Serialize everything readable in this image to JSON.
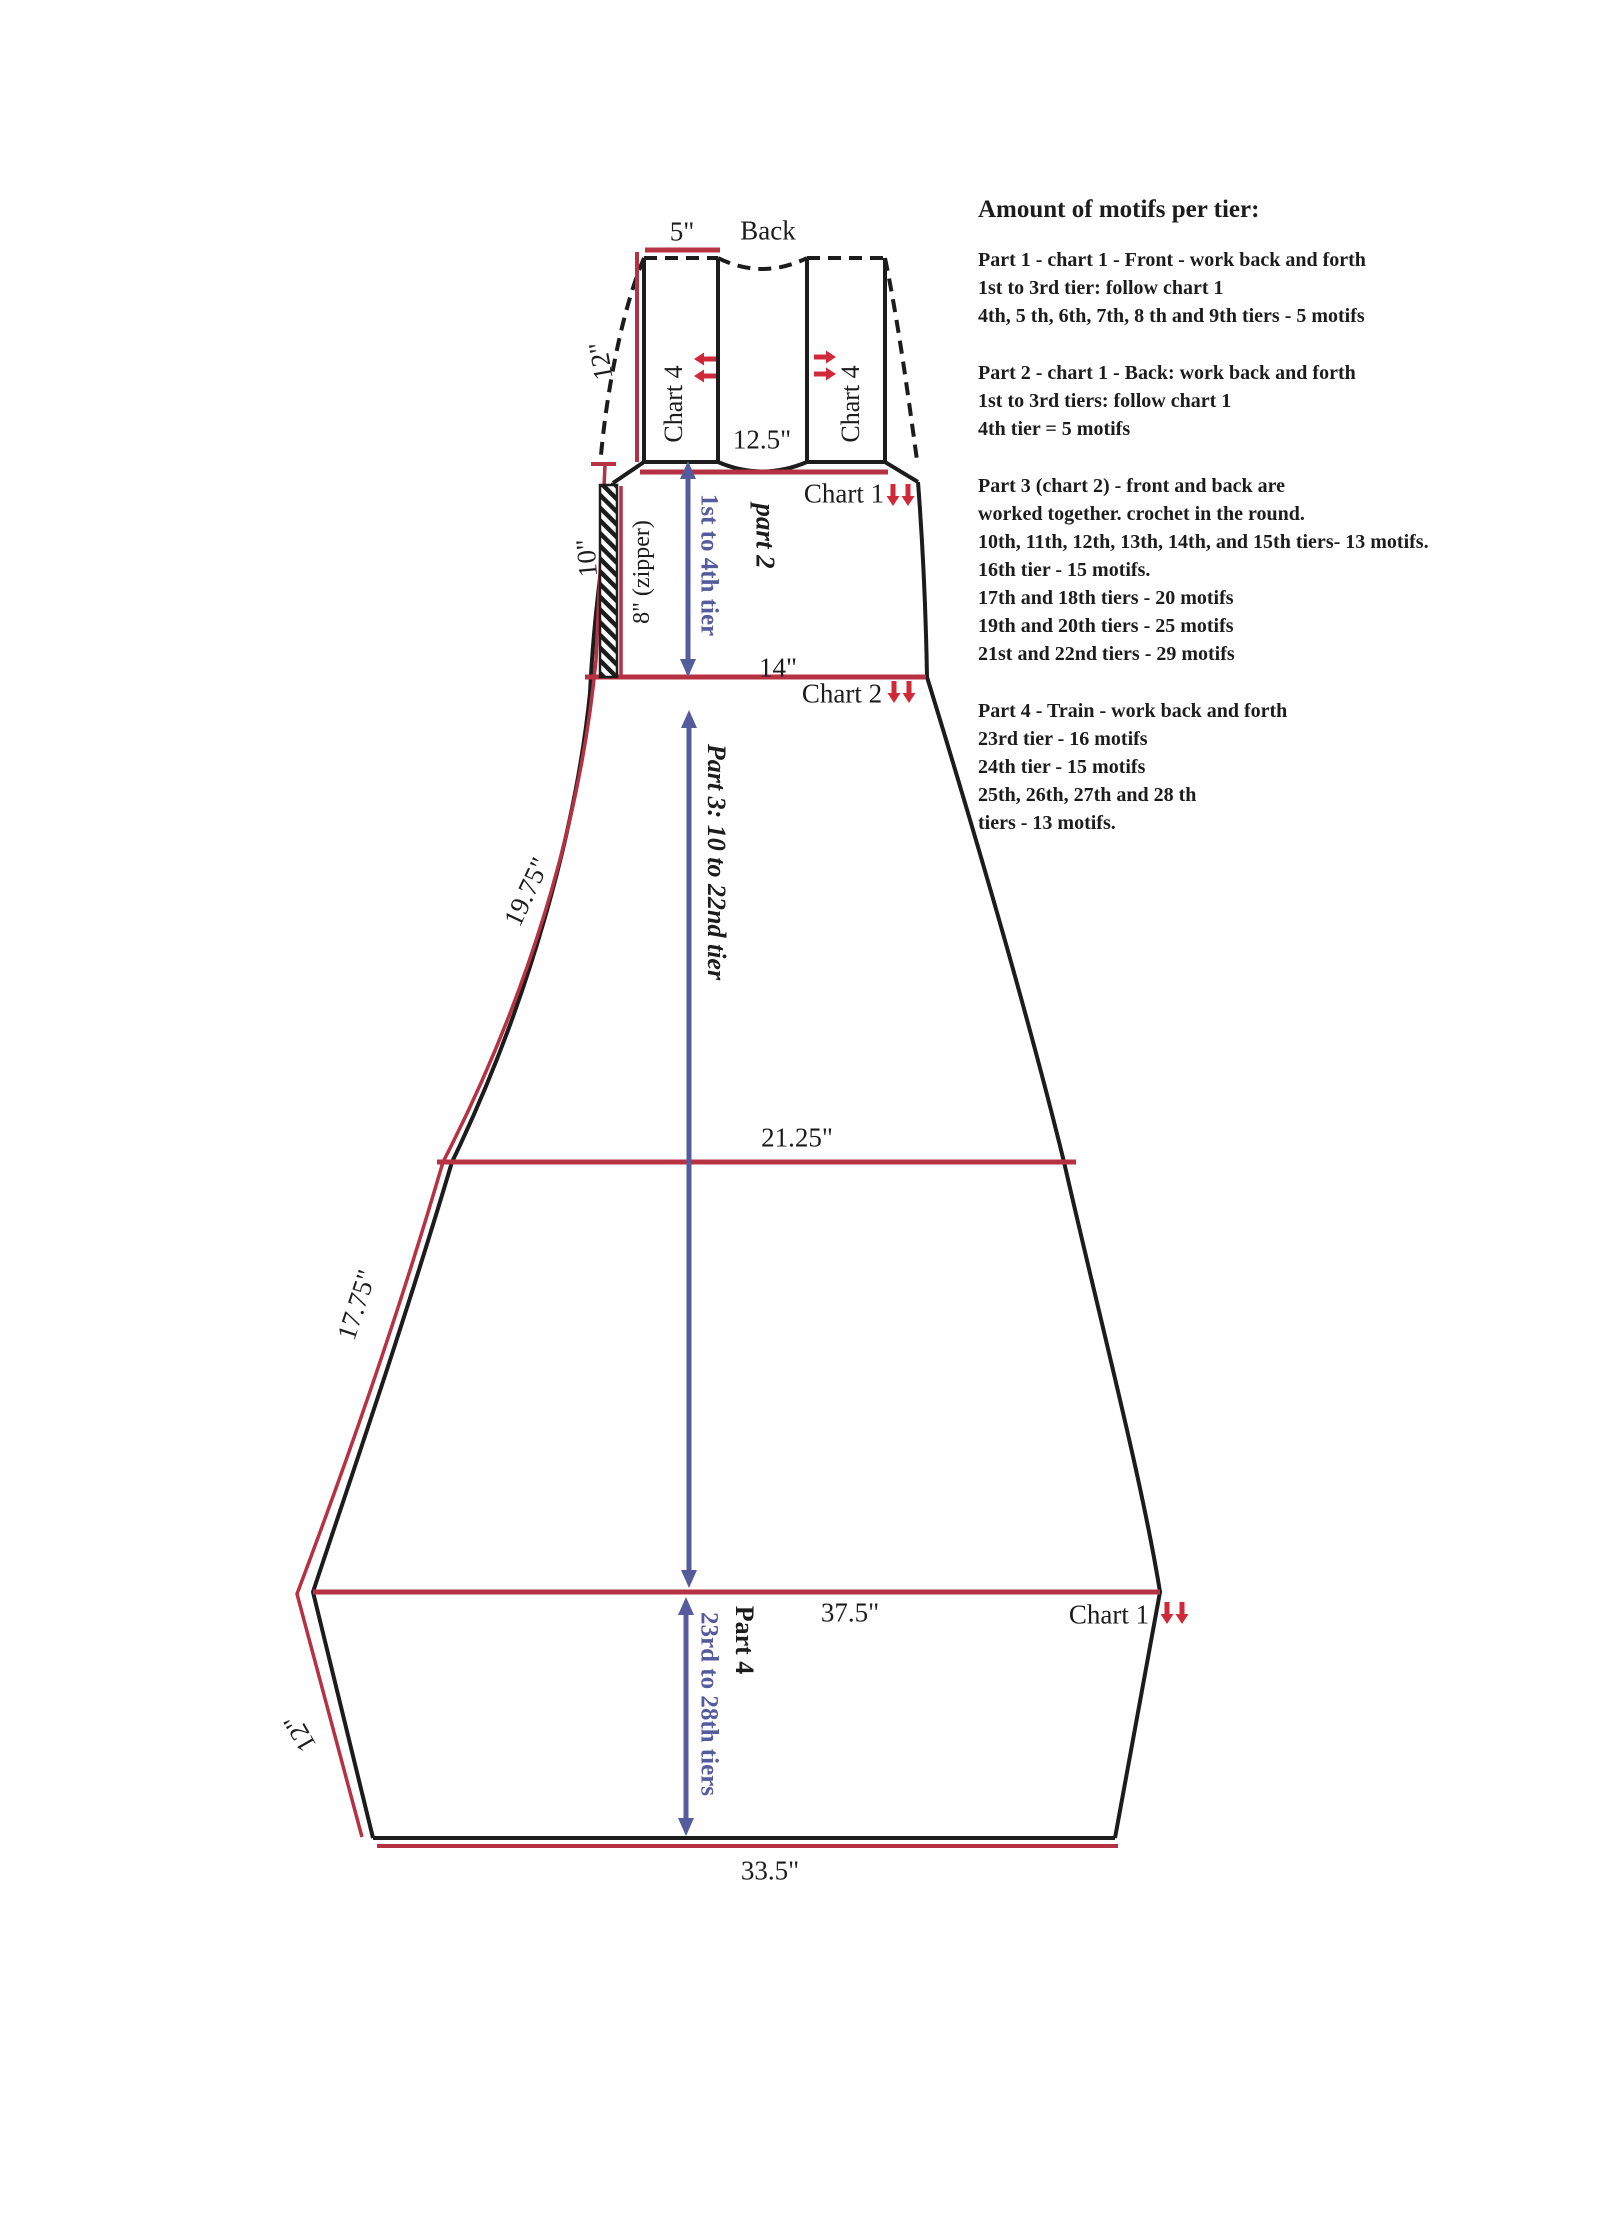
{
  "labels": {
    "five_in": "5\"",
    "back": "Back",
    "twelve_top": "12\"",
    "chart4_left": "Chart 4",
    "chart4_right": "Chart 4",
    "twelve_five": "12.5\"",
    "chart1_top": "Chart 1",
    "ten_in": "10\"",
    "zipper": "8\" (zipper)",
    "first_to_4th": "1st to 4th tier",
    "part2": "part 2",
    "fourteen": "14\"",
    "chart2": "Chart 2",
    "part3": "Part 3: 10 to 22nd tier",
    "nineteen_75": "19.75\"",
    "twentyone_25": "21.25\"",
    "seventeen_75": "17.75\"",
    "thirtyseven_5": "37.5\"",
    "chart1_bottom": "Chart 1",
    "part4": "Part 4",
    "tiers_23_28": "23rd to 28th tiers",
    "twelve_bottom": "12\"",
    "thirtythree_5": "33.5\""
  },
  "motifs": {
    "heading": "Amount of motifs per tier:",
    "p1": {
      "lines": [
        "Part 1 - chart 1 - Front - work back and forth",
        "1st to 3rd tier: follow chart 1",
        "4th, 5 th, 6th, 7th, 8 th and 9th tiers - 5 motifs"
      ]
    },
    "p2": {
      "lines": [
        "Part 2 - chart 1 - Back: work back and forth",
        "1st to 3rd tiers: follow chart 1",
        "4th tier = 5 motifs"
      ]
    },
    "p3": {
      "lines": [
        "Part 3 (chart 2) - front and back are",
        "worked together. crochet in the round.",
        "10th, 11th, 12th, 13th, 14th, and 15th tiers- 13 motifs.",
        "16th tier - 15 motifs.",
        "17th and 18th tiers - 20 motifs",
        "19th and 20th tiers - 25 motifs",
        "21st and 22nd tiers - 29 motifs"
      ]
    },
    "p4": {
      "lines": [
        "Part 4 - Train - work back and forth",
        "23rd tier - 16 motifs",
        "24th tier - 15 motifs",
        "25th, 26th, 27th and 28 th",
        "tiers - 13 motifs."
      ]
    }
  },
  "colors": {
    "outline_black": "#1c1c1c",
    "measure_red": "#b63142",
    "arrow_red": "#d02a3a",
    "arrow_blue": "#565b9d"
  }
}
